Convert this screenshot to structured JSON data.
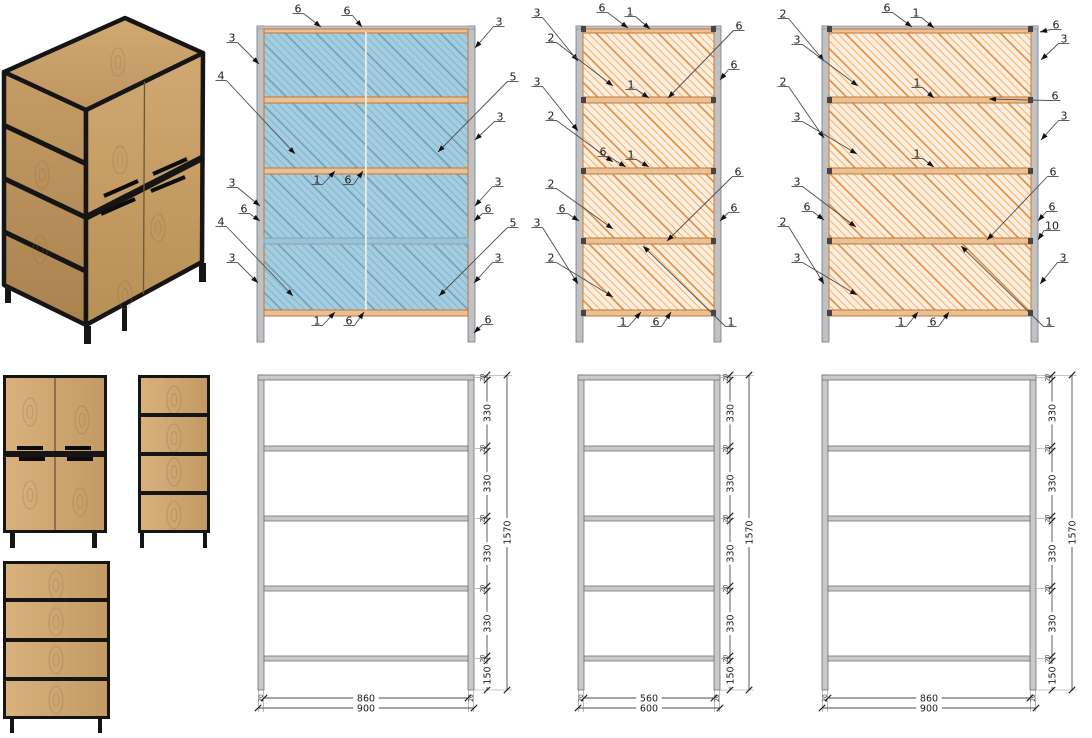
{
  "page": {
    "title": "Cabinet technical drawing sheet",
    "background": "#ffffff"
  },
  "colors": {
    "blue_panel": "#a3cde1",
    "blue_hatch": "#86b5ca",
    "blue_hatch_strong": "#6f9fb6",
    "orange_panel": "#fdeedd",
    "orange_hatch": "#f3b275",
    "orange_hatch_strong": "#e2873a",
    "rail_fill": "#e7c197",
    "rail_stroke": "#c9752c",
    "glass_rail_fill": "#9ec3d4",
    "glass_rail_stroke": "#7ba6bb",
    "post_fill": "#c0c1c4",
    "post_stroke": "#77787a",
    "corner_dark": "#454547",
    "frame_fill": "#c8c9cb",
    "frame_stroke": "#707174",
    "leader": "#4d4d4f",
    "arrow": "#111111",
    "dim_line": "#4d4d4f",
    "text": "#1c1c1c",
    "center_gap": "#f2ecd7",
    "black_frame": "#151515",
    "wood_light": "#d9b17c",
    "wood_dark": "#c39a64"
  },
  "drawing": {
    "elevations": [
      {
        "id": "front-elevation",
        "panel": "blue",
        "xl": 257,
        "xr": 468,
        "pw": 7,
        "railYs": [
          26,
          97,
          168,
          238,
          310
        ],
        "railH": 6,
        "legBottom": 342,
        "centerX": 366,
        "corner": false,
        "railStyles": [
          "tan",
          "tan",
          "tan",
          "blue",
          "tan"
        ],
        "callouts": [
          [
            "6",
            298,
            9,
            321,
            27
          ],
          [
            "6",
            347,
            11,
            362,
            27
          ],
          [
            "3",
            499,
            22,
            475,
            48
          ],
          [
            "3",
            232,
            38,
            259,
            64
          ],
          [
            "4",
            221,
            76,
            295,
            154
          ],
          [
            "5",
            513,
            77,
            438,
            152
          ],
          [
            "3",
            500,
            117,
            475,
            140
          ],
          [
            "1",
            317,
            180,
            335,
            171
          ],
          [
            "6",
            348,
            180,
            363,
            171
          ],
          [
            "3",
            232,
            183,
            260,
            206
          ],
          [
            "6",
            244,
            209,
            260,
            221
          ],
          [
            "3",
            498,
            182,
            475,
            206
          ],
          [
            "6",
            488,
            209,
            474,
            221
          ],
          [
            "4",
            221,
            222,
            293,
            296
          ],
          [
            "5",
            513,
            223,
            439,
            296
          ],
          [
            "3",
            232,
            258,
            258,
            283
          ],
          [
            "3",
            498,
            258,
            474,
            283
          ],
          [
            "1",
            317,
            321,
            335,
            312
          ],
          [
            "6",
            349,
            321,
            364,
            312
          ],
          [
            "6",
            488,
            320,
            474,
            333
          ]
        ]
      },
      {
        "id": "side-elevation-narrow",
        "panel": "orange",
        "xl": 576,
        "xr": 714,
        "pw": 7,
        "railYs": [
          26,
          97,
          168,
          238,
          310
        ],
        "railH": 6,
        "legBottom": 342,
        "centerX": null,
        "corner": true,
        "railStyles": [
          "tan",
          "tan",
          "tan",
          "tan",
          "tan"
        ],
        "callouts": [
          [
            "6",
            602,
            8,
            628,
            28
          ],
          [
            "1",
            630,
            12,
            650,
            29
          ],
          [
            "3",
            537,
            13,
            578,
            61
          ],
          [
            "2",
            551,
            38,
            613,
            86
          ],
          [
            "6",
            739,
            26,
            668,
            98
          ],
          [
            "6",
            734,
            65,
            720,
            80
          ],
          [
            "3",
            537,
            82,
            578,
            131
          ],
          [
            "2",
            551,
            116,
            613,
            162
          ],
          [
            "1",
            631,
            85,
            649,
            98
          ],
          [
            "6",
            603,
            152,
            626,
            167
          ],
          [
            "1",
            631,
            155,
            649,
            167
          ],
          [
            "2",
            551,
            184,
            613,
            229
          ],
          [
            "6",
            562,
            209,
            579,
            221
          ],
          [
            "3",
            537,
            223,
            578,
            284
          ],
          [
            "2",
            551,
            258,
            613,
            297
          ],
          [
            "6",
            738,
            172,
            667,
            241
          ],
          [
            "6",
            734,
            208,
            720,
            221
          ],
          [
            "1",
            623,
            322,
            641,
            312
          ],
          [
            "6",
            656,
            322,
            671,
            312
          ],
          [
            "1",
            731,
            322,
            643,
            246
          ]
        ]
      },
      {
        "id": "side-elevation-wide",
        "panel": "orange",
        "xl": 822,
        "xr": 1031,
        "pw": 7,
        "railYs": [
          26,
          97,
          168,
          238,
          310
        ],
        "railH": 6,
        "legBottom": 342,
        "centerX": null,
        "corner": true,
        "railStyles": [
          "tan",
          "tan",
          "tan",
          "tan",
          "tan"
        ],
        "callouts": [
          [
            "6",
            887,
            8,
            912,
            27
          ],
          [
            "1",
            916,
            13,
            934,
            28
          ],
          [
            "2",
            783,
            14,
            824,
            61
          ],
          [
            "3",
            797,
            40,
            858,
            86
          ],
          [
            "6",
            1056,
            25,
            1040,
            32
          ],
          [
            "3",
            1064,
            39,
            1041,
            60
          ],
          [
            "2",
            783,
            82,
            824,
            138
          ],
          [
            "3",
            797,
            117,
            857,
            154
          ],
          [
            "6",
            1055,
            96,
            989,
            99
          ],
          [
            "3",
            1064,
            116,
            1041,
            140
          ],
          [
            "1",
            917,
            83,
            934,
            98
          ],
          [
            "1",
            917,
            154,
            934,
            167
          ],
          [
            "6",
            1053,
            172,
            987,
            240
          ],
          [
            "3",
            797,
            182,
            856,
            227
          ],
          [
            "6",
            807,
            207,
            824,
            220
          ],
          [
            "2",
            783,
            222,
            824,
            284
          ],
          [
            "3",
            797,
            258,
            857,
            295
          ],
          [
            "6",
            1052,
            207,
            1038,
            221
          ],
          [
            "10",
            1052,
            226,
            1038,
            240
          ],
          [
            "3",
            1063,
            258,
            1040,
            284
          ],
          [
            "1",
            901,
            322,
            918,
            312
          ],
          [
            "6",
            933,
            322,
            949,
            312
          ],
          [
            "1",
            1049,
            322,
            961,
            246
          ]
        ]
      }
    ],
    "dim_common": {
      "railYs": [
        375,
        446,
        516,
        586,
        656
      ],
      "railH": 5,
      "legBottom": 690,
      "innerY": 698,
      "outerY": 708,
      "segments": [
        "330",
        "330",
        "330",
        "330"
      ],
      "bottomSeg": "150",
      "total": "1570",
      "railThickness": "20",
      "postWidth": "20"
    },
    "dim_frames": [
      {
        "id": "dim-frame-900-left",
        "xl": 258,
        "xr": 468,
        "pw": 6,
        "chainX": 487,
        "totalX": 507,
        "inner": "860",
        "outer": "900"
      },
      {
        "id": "dim-frame-600",
        "xl": 578,
        "xr": 714,
        "pw": 6,
        "chainX": 730,
        "totalX": 749,
        "inner": "560",
        "outer": "600"
      },
      {
        "id": "dim-frame-900-right",
        "xl": 822,
        "xr": 1030,
        "pw": 6,
        "chainX": 1052,
        "totalX": 1072,
        "inner": "860",
        "outer": "900"
      }
    ],
    "flat_views": {
      "front": {
        "frame": [
          3,
          375,
          104,
          158
        ],
        "midBand": [
          6,
          451,
          98,
          6
        ],
        "centerX": 55,
        "handles": [
          [
            17,
            446,
            26,
            4
          ],
          [
            65,
            446,
            26,
            4
          ],
          [
            19,
            457,
            26,
            4
          ],
          [
            67,
            457,
            26,
            4
          ]
        ],
        "legs": [
          [
            10,
            533,
            5,
            15
          ],
          [
            92,
            533,
            5,
            15
          ]
        ],
        "knots": [
          [
            30,
            412
          ],
          [
            82,
            420
          ],
          [
            30,
            495
          ],
          [
            80,
            502
          ]
        ]
      },
      "side": {
        "frame": [
          138,
          375,
          72,
          158
        ],
        "divs": [
          413,
          452,
          491
        ],
        "legs": [
          [
            140,
            533,
            4,
            15
          ],
          [
            203,
            533,
            4,
            15
          ]
        ],
        "knots": [
          [
            174,
            400
          ],
          [
            174,
            438
          ],
          [
            174,
            472
          ],
          [
            174,
            515
          ]
        ]
      },
      "back": {
        "frame": [
          3,
          561,
          107,
          158
        ],
        "divs": [
          598,
          638,
          677
        ],
        "legs": [
          [
            10,
            719,
            4,
            14
          ],
          [
            98,
            719,
            4,
            14
          ]
        ],
        "knots": [
          [
            56,
            585
          ],
          [
            56,
            622
          ],
          [
            56,
            660
          ],
          [
            56,
            700
          ]
        ]
      }
    },
    "photo3d": {
      "top": [
        [
          4,
          72
        ],
        [
          125,
          18
        ],
        [
          203,
          53
        ],
        [
          86,
          110
        ]
      ],
      "left": [
        [
          4,
          72
        ],
        [
          86,
          110
        ],
        [
          86,
          325
        ],
        [
          4,
          285
        ]
      ],
      "front": [
        [
          86,
          110
        ],
        [
          203,
          53
        ],
        [
          202,
          262
        ],
        [
          86,
          325
        ]
      ],
      "legs": [
        [
          5,
          286,
          6,
          17
        ],
        [
          84,
          326,
          7,
          18
        ],
        [
          199,
          263,
          7,
          19
        ],
        [
          122,
          303,
          5,
          28
        ]
      ],
      "handles": [
        [
          104,
          196,
          138,
          181
        ],
        [
          153,
          174,
          187,
          159
        ],
        [
          101,
          214,
          135,
          199
        ],
        [
          151,
          191,
          185,
          177
        ]
      ],
      "dividers_t": [
        0.25,
        0.5,
        0.75
      ],
      "mid_t": 0.5,
      "gap_top": [
        144.5,
        81.5
      ],
      "gap_bot": [
        143.5,
        294
      ],
      "knots": [
        [
          42,
          175
        ],
        [
          40,
          250
        ],
        [
          120,
          160
        ],
        [
          158,
          228
        ],
        [
          118,
          62
        ],
        [
          125,
          295
        ]
      ]
    }
  }
}
